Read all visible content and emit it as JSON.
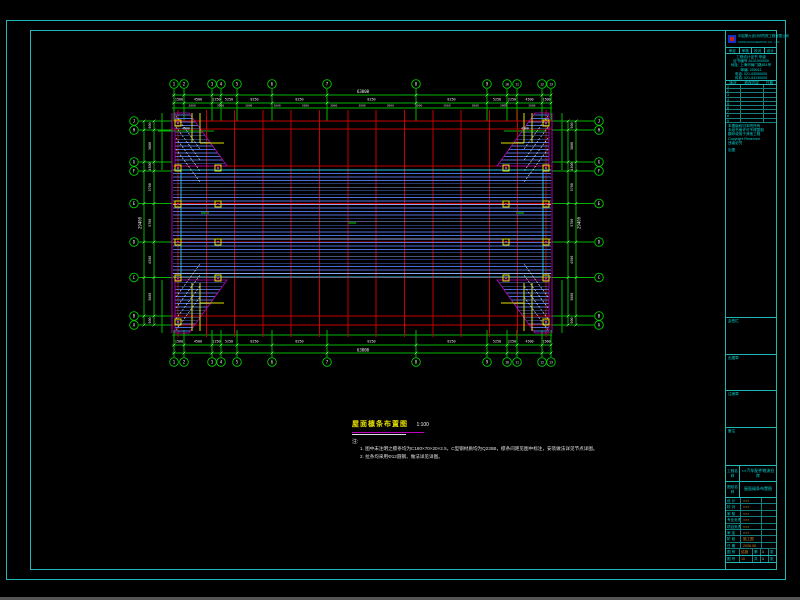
{
  "app": {
    "background": "#000000",
    "taskbar_color": "#555555"
  },
  "colors": {
    "frame": "#1fb6b6",
    "grid_green": "#00b400",
    "axis_red": "#c40000",
    "purlin_blue": "#4f6fd8",
    "purlin_light": "#8ea8ef",
    "outline_magenta": "#c000c0",
    "column_yellow": "#e0e000",
    "text_white": "#f0f0f0",
    "cyan_text": "#00d8d8",
    "value_orange": "#d2882a",
    "eave_cyan": "#25c0e8"
  },
  "geom": {
    "frame": {
      "outer": {
        "x": 6,
        "y": 20,
        "w": 780,
        "h": 560
      },
      "inner": {
        "x": 30,
        "y": 30,
        "w": 747,
        "h": 540
      }
    },
    "plan": {
      "left": 172,
      "right": 552,
      "top": 121,
      "bottom": 325,
      "red_h": [
        121,
        129,
        166,
        170,
        203.5,
        242,
        277.5,
        316,
        325
      ],
      "red_v_from": 178,
      "red_v_to": 546,
      "red_v_count": 14,
      "field": {
        "top": 170,
        "bottom": 277.5,
        "spacing": 3.45,
        "x1": 173,
        "x2": 551
      },
      "cyan_v": [
        181,
        543
      ],
      "wedge": {
        "top_y": 113,
        "bot_y": 333,
        "edge_x": 189,
        "hyp_to_x": 227,
        "hyp_to_y": 166
      },
      "interior_marks": [
        [
          352,
          223
        ],
        [
          205,
          213
        ],
        [
          520,
          213
        ]
      ]
    }
  },
  "grid": {
    "top": {
      "y": 84,
      "xs": [
        174,
        184,
        212,
        221,
        237,
        272,
        327,
        416,
        487,
        507,
        517,
        542,
        551
      ],
      "labels": [
        "1",
        "2",
        "3",
        "4",
        "5",
        "6",
        "7",
        "8",
        "9",
        "10",
        "11",
        "12",
        "13"
      ]
    },
    "bottom": {
      "y": 362
    },
    "left": {
      "x": 134,
      "ys": [
        121,
        130,
        162,
        171,
        203.5,
        242,
        277.5,
        316,
        325
      ],
      "labels": [
        "J",
        "H",
        "G",
        "F",
        "E",
        "D",
        "C",
        "B",
        "A"
      ]
    },
    "right": {
      "x": 599
    }
  },
  "dims": {
    "top": {
      "overall": "63000",
      "segments": [
        "1500",
        "4500",
        "2250",
        "5250",
        "8250",
        "8250",
        "8250",
        "8250",
        "5250",
        "2250",
        "4500",
        "1500"
      ],
      "sub_value": "3000"
    },
    "bottom": {
      "overall": "63000",
      "segments": [
        "1500",
        "4500",
        "2250",
        "5250",
        "8250",
        "8250",
        "8250",
        "8250",
        "5250",
        "2250",
        "4500",
        "1500"
      ]
    },
    "left": {
      "overall": "29400",
      "segments": [
        "900",
        "3600",
        "4500",
        "5700",
        "5700",
        "4500",
        "3600",
        "900"
      ]
    },
    "right": {
      "overall": "29400",
      "segments": [
        "900",
        "3600",
        "4500",
        "5700",
        "5700",
        "4500",
        "3600",
        "900"
      ]
    },
    "corner_chain": "4500"
  },
  "notes": {
    "title": "屋面檩条布置图",
    "scale": "1:100",
    "label": "注:",
    "items": [
      "1. 图中未注明之檩条均为C180×70×20×2.5，C型钢材质均为Q235B，檩条间距见图中标注，安装做法详见节点详图。",
      "2. 拉条均采用Φ12圆钢，做法详见详图。"
    ]
  },
  "titleblock": {
    "company": "中船第九设计研究院工程有限公司",
    "company_en": "SNDRI ENGINEERING CO., LTD.",
    "approve_cells": [
      "审定",
      "审核",
      "校对",
      "设计"
    ],
    "info_lines": [
      "工程设计证书 甲级",
      "证书编号 A131000000",
      "地址: 上海市局门路851号",
      "邮编: 200011",
      "电话: 021-63050000",
      "传真: 021-63130000"
    ],
    "rev_header": [
      "版次",
      "修改内容",
      "日期"
    ],
    "rev_rows": [
      "1",
      "2",
      "3",
      "4",
      "5",
      "6",
      "7",
      "8",
      "9"
    ],
    "legal_lines": [
      "本图版权归本院所有",
      "未经书面许可不得复制",
      "翻印或用于其他工程",
      "Copyright Reserved",
      "违者必究"
    ],
    "out_label": "出图",
    "sections": [
      {
        "y": 286,
        "label": "会签栏"
      },
      {
        "y": 323,
        "label": "出图章"
      },
      {
        "y": 359,
        "label": "注册章"
      },
      {
        "y": 396,
        "label": "备注"
      }
    ],
    "project_label": "工程名称",
    "project_value": "××汽车配件物流仓库",
    "drawing_label": "图纸名称",
    "drawing_value": "屋面檩条布置图",
    "small_rows": [
      {
        "label": "设 计",
        "value": "×××"
      },
      {
        "label": "校 对",
        "value": "×××"
      },
      {
        "label": "审 核",
        "value": "×××"
      },
      {
        "label": "专业负责",
        "value": "×××"
      },
      {
        "label": "项目负责",
        "value": "×××"
      },
      {
        "label": "审 定",
        "value": "×××"
      },
      {
        "label": "阶 段",
        "value": "施工图"
      },
      {
        "label": "日 期",
        "value": "2008.06"
      }
    ],
    "bottom_rows": [
      {
        "label": "图 别",
        "value": "结施",
        "e1": "第",
        "e1v": "1",
        "e2": "张"
      },
      {
        "label": "图 号",
        "value": "10",
        "e1": "共",
        "e1v": "1",
        "e2": "张"
      }
    ]
  }
}
